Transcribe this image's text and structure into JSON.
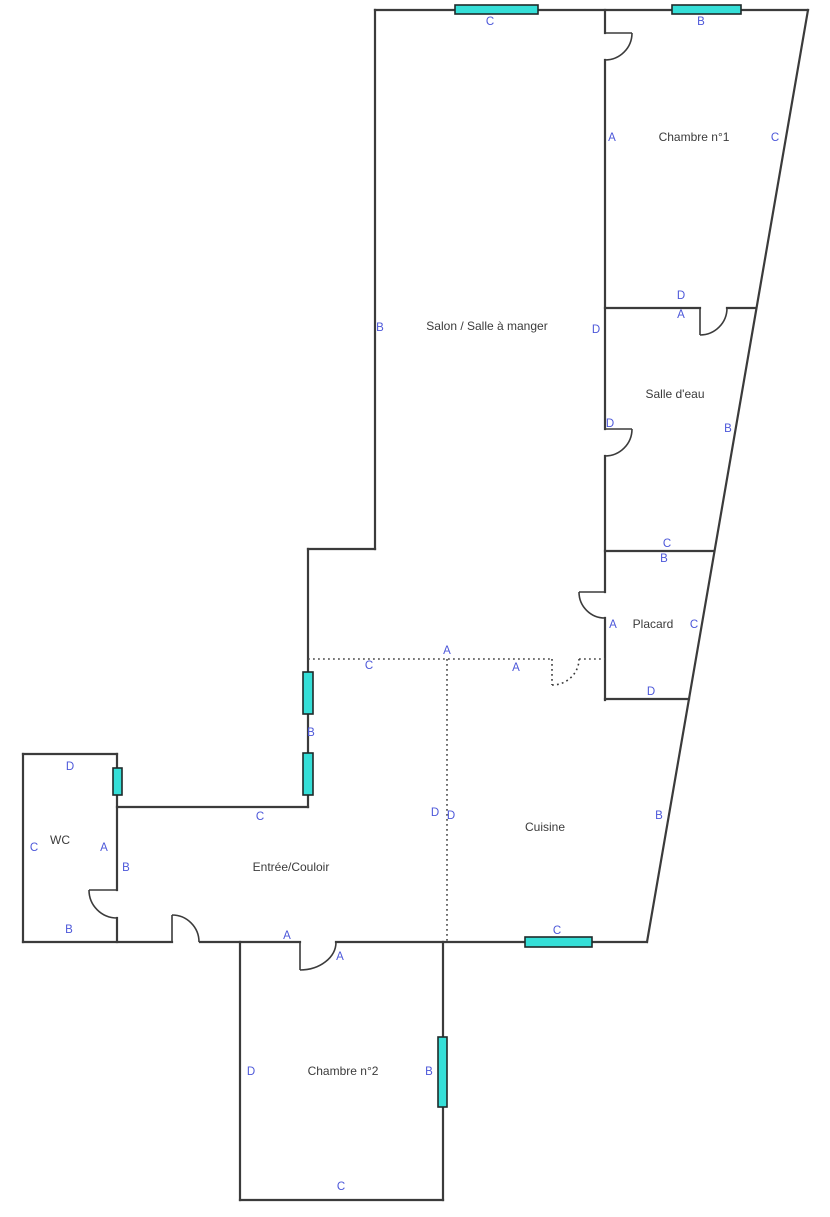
{
  "plan": {
    "width": 830,
    "height": 1212,
    "colors": {
      "background": "#ffffff",
      "wall": "#3b3b3b",
      "dotted": "#4a4a4a",
      "door": "#3b3b3b",
      "window_fill": "#35dfd8",
      "window_stroke": "#1f2a2a",
      "label_blue": "#4c57d9",
      "room_text": "#3b3b3b"
    },
    "rooms": [
      {
        "name": "Chambre n°1",
        "x": 694,
        "y": 138
      },
      {
        "name": "Salon / Salle à manger",
        "x": 487,
        "y": 327
      },
      {
        "name": "Salle d'eau",
        "x": 675,
        "y": 395
      },
      {
        "name": "Placard",
        "x": 653,
        "y": 625
      },
      {
        "name": "Cuisine",
        "x": 545,
        "y": 828
      },
      {
        "name": "Entrée/Couloir",
        "x": 291,
        "y": 868
      },
      {
        "name": "WC",
        "x": 60,
        "y": 841
      },
      {
        "name": "Chambre n°2",
        "x": 343,
        "y": 1072
      }
    ],
    "wall_labels": [
      {
        "text": "C",
        "x": 490,
        "y": 22
      },
      {
        "text": "B",
        "x": 701,
        "y": 22
      },
      {
        "text": "A",
        "x": 612,
        "y": 138
      },
      {
        "text": "C",
        "x": 775,
        "y": 138
      },
      {
        "text": "D",
        "x": 681,
        "y": 296
      },
      {
        "text": "A",
        "x": 681,
        "y": 315
      },
      {
        "text": "B",
        "x": 380,
        "y": 328
      },
      {
        "text": "D",
        "x": 596,
        "y": 330
      },
      {
        "text": "D",
        "x": 610,
        "y": 424
      },
      {
        "text": "B",
        "x": 728,
        "y": 429
      },
      {
        "text": "C",
        "x": 667,
        "y": 544
      },
      {
        "text": "B",
        "x": 664,
        "y": 559
      },
      {
        "text": "A",
        "x": 613,
        "y": 625
      },
      {
        "text": "C",
        "x": 694,
        "y": 625
      },
      {
        "text": "D",
        "x": 651,
        "y": 692
      },
      {
        "text": "A",
        "x": 447,
        "y": 651
      },
      {
        "text": "C",
        "x": 369,
        "y": 666
      },
      {
        "text": "A",
        "x": 516,
        "y": 668
      },
      {
        "text": "B",
        "x": 311,
        "y": 733
      },
      {
        "text": "D",
        "x": 70,
        "y": 767
      },
      {
        "text": "C",
        "x": 260,
        "y": 817
      },
      {
        "text": "C",
        "x": 34,
        "y": 848
      },
      {
        "text": "A",
        "x": 104,
        "y": 848
      },
      {
        "text": "B",
        "x": 126,
        "y": 868
      },
      {
        "text": "B",
        "x": 69,
        "y": 930
      },
      {
        "text": "A",
        "x": 287,
        "y": 936
      },
      {
        "text": "D",
        "x": 435,
        "y": 813
      },
      {
        "text": "D",
        "x": 451,
        "y": 816
      },
      {
        "text": "B",
        "x": 659,
        "y": 816
      },
      {
        "text": "C",
        "x": 557,
        "y": 931
      },
      {
        "text": "A",
        "x": 340,
        "y": 957
      },
      {
        "text": "D",
        "x": 251,
        "y": 1072
      },
      {
        "text": "B",
        "x": 429,
        "y": 1072
      },
      {
        "text": "C",
        "x": 341,
        "y": 1187
      }
    ],
    "walls": [
      [
        375,
        10,
        808,
        10
      ],
      [
        808,
        10,
        647,
        942
      ],
      [
        647,
        942,
        336,
        942
      ],
      [
        300,
        942,
        200,
        942
      ],
      [
        172,
        942,
        23,
        942
      ],
      [
        23,
        942,
        23,
        754
      ],
      [
        23,
        754,
        117,
        754
      ],
      [
        117,
        754,
        117,
        890
      ],
      [
        117,
        918,
        117,
        942
      ],
      [
        117,
        807,
        308,
        807
      ],
      [
        308,
        807,
        308,
        549
      ],
      [
        308,
        549,
        375,
        549
      ],
      [
        375,
        549,
        375,
        10
      ],
      [
        240,
        942,
        240,
        1200
      ],
      [
        240,
        1200,
        443,
        1200
      ],
      [
        443,
        1200,
        443,
        942
      ],
      [
        605,
        10,
        605,
        33
      ],
      [
        605,
        60,
        605,
        429
      ],
      [
        605,
        456,
        605,
        592
      ],
      [
        605,
        618,
        605,
        700
      ],
      [
        605,
        308,
        700,
        308
      ],
      [
        727,
        308,
        756,
        308
      ],
      [
        605,
        551,
        714,
        551
      ],
      [
        605,
        699,
        689,
        699
      ]
    ],
    "dotted_lines": [
      [
        308,
        659,
        552,
        659
      ],
      [
        579,
        659,
        605,
        659
      ],
      [
        447,
        659,
        447,
        942
      ]
    ],
    "doors": [
      {
        "hinge": [
          605,
          33
        ],
        "tip": [
          632,
          33
        ],
        "end": [
          605,
          60
        ],
        "style": "solid"
      },
      {
        "hinge": [
          700,
          308
        ],
        "tip": [
          700,
          335
        ],
        "end": [
          727,
          308
        ],
        "style": "solid"
      },
      {
        "hinge": [
          605,
          429
        ],
        "tip": [
          632,
          429
        ],
        "end": [
          605,
          456
        ],
        "style": "solid"
      },
      {
        "hinge": [
          605,
          592
        ],
        "tip": [
          579,
          592
        ],
        "end": [
          605,
          618
        ],
        "style": "solid"
      },
      {
        "hinge": [
          117,
          890
        ],
        "tip": [
          89,
          890
        ],
        "end": [
          117,
          918
        ],
        "style": "solid"
      },
      {
        "hinge": [
          172,
          942
        ],
        "tip": [
          172,
          915
        ],
        "end": [
          199,
          942
        ],
        "style": "solid"
      },
      {
        "hinge": [
          300,
          942
        ],
        "tip": [
          300,
          970
        ],
        "end": [
          336,
          942
        ],
        "style": "solid"
      },
      {
        "hinge": [
          552,
          659
        ],
        "tip": [
          552,
          685
        ],
        "end": [
          579,
          659
        ],
        "style": "dotted"
      }
    ],
    "windows": [
      {
        "x": 455,
        "y": 5,
        "w": 83,
        "h": 9
      },
      {
        "x": 672,
        "y": 5,
        "w": 69,
        "h": 9
      },
      {
        "x": 303,
        "y": 672,
        "w": 10,
        "h": 42
      },
      {
        "x": 303,
        "y": 753,
        "w": 10,
        "h": 42
      },
      {
        "x": 113,
        "y": 768,
        "w": 9,
        "h": 27
      },
      {
        "x": 525,
        "y": 937,
        "w": 67,
        "h": 10
      },
      {
        "x": 438,
        "y": 1037,
        "w": 9,
        "h": 70
      }
    ]
  }
}
